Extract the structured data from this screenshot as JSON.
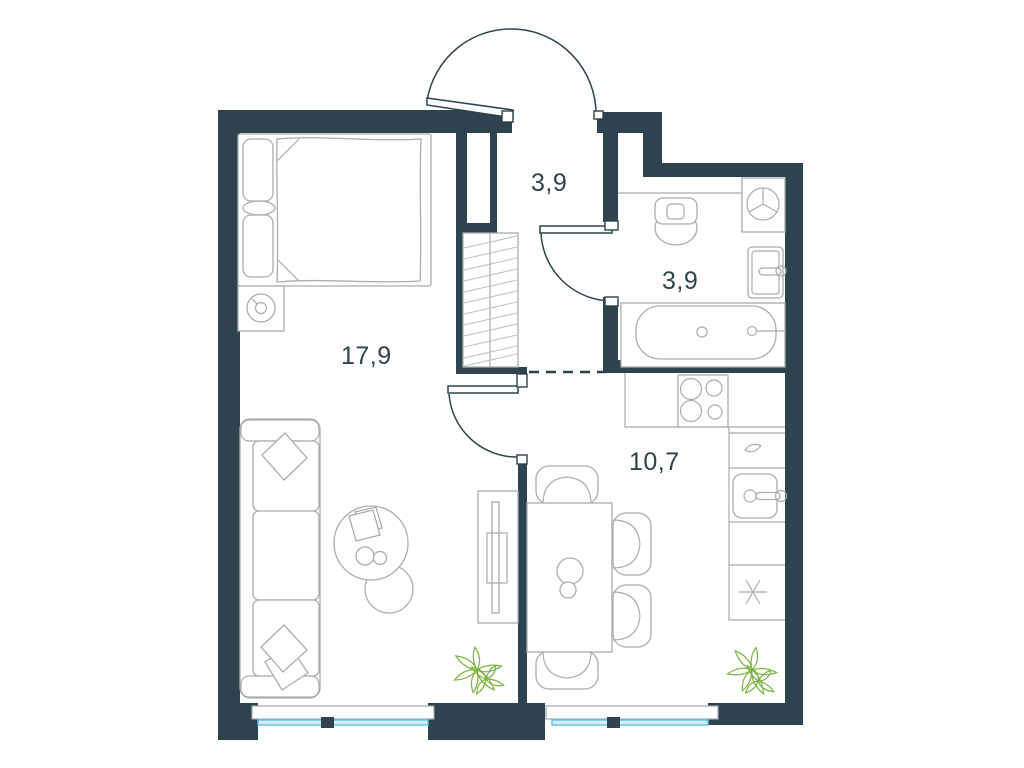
{
  "plan": {
    "title": "One-bedroom apartment floor plan",
    "rooms": {
      "living": {
        "name": "living-room-bedroom",
        "area": "17,9"
      },
      "hallway": {
        "name": "hallway",
        "area": "3,9"
      },
      "bathroom": {
        "name": "bathroom",
        "area": "3,9"
      },
      "kitchen": {
        "name": "kitchen-dining",
        "area": "10,7"
      }
    },
    "fixtures": [
      "entrance-door",
      "bathroom-door",
      "living-room-door",
      "open-passage-dashed",
      "double-bed",
      "pillows",
      "nightstand",
      "lamp",
      "wardrobe",
      "sofa",
      "sofa-pillows",
      "coffee-table",
      "tv-stand",
      "dining-table",
      "dining-chairs",
      "stove-4-burners",
      "kitchen-counter",
      "kitchen-sink",
      "fridge-snowflake",
      "toilet",
      "washing-machine",
      "bathroom-sink",
      "bathtub",
      "window-left",
      "window-right",
      "plant-left",
      "plant-right"
    ],
    "colors": {
      "wall": "#2e434d",
      "furniture_line": "#a8aeb1",
      "window_glass": "#d6edf8",
      "window_frame": "#62c1e5",
      "plant": "#7cb342",
      "label": "#2e434d",
      "background": "#ffffff"
    }
  }
}
